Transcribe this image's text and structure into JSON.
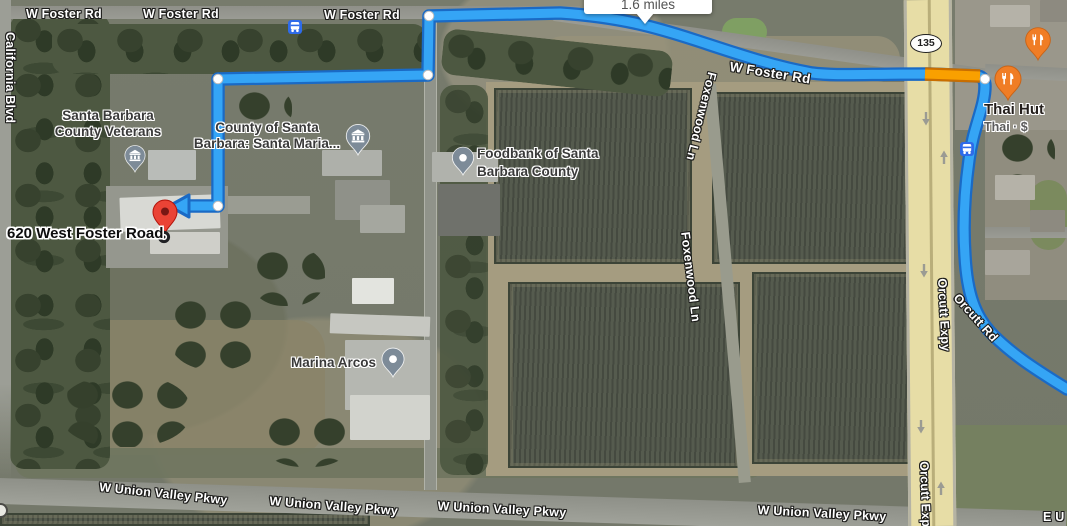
{
  "colors": {
    "route_blue": "#35a5f5",
    "route_border": "#1a6ac5",
    "traffic_orange": "#f9a000",
    "traffic_orange_border": "#c96e00",
    "destination_pin_red": "#ea4335",
    "poi_pin_gray": "#7d8b98",
    "restaurant_pin_orange": "#f07d25",
    "transit_blue": "#2e6bea",
    "highway_tan": "#e7dda6"
  },
  "tooltip": {
    "distance": "1.6 miles"
  },
  "route": {
    "badge": "135"
  },
  "roads": {
    "w_foster": "W Foster Rd",
    "california_blvd": "California Blvd",
    "foxenwood_ln": "Foxenwood Ln",
    "orcutt_expy": "Orcutt Expy",
    "orcutt_rd": "Orcutt Rd",
    "w_union_valley": "W Union Valley Pkwy",
    "e_union_partial": "E U"
  },
  "places": {
    "veterans": {
      "line1": "Santa Barbara",
      "line2": "County Veterans"
    },
    "county": {
      "line1": "County of Santa",
      "line2": "Barbara: Santa Maria..."
    },
    "foodbank": {
      "line1": "Foodbank of Santa",
      "line2": "Barbara County"
    },
    "marina": {
      "name": "Marina Arcos"
    },
    "thai_hut": {
      "name": "Thai Hut",
      "detail": "Thai · $"
    },
    "destination": {
      "name": "620 West Foster Road"
    }
  }
}
